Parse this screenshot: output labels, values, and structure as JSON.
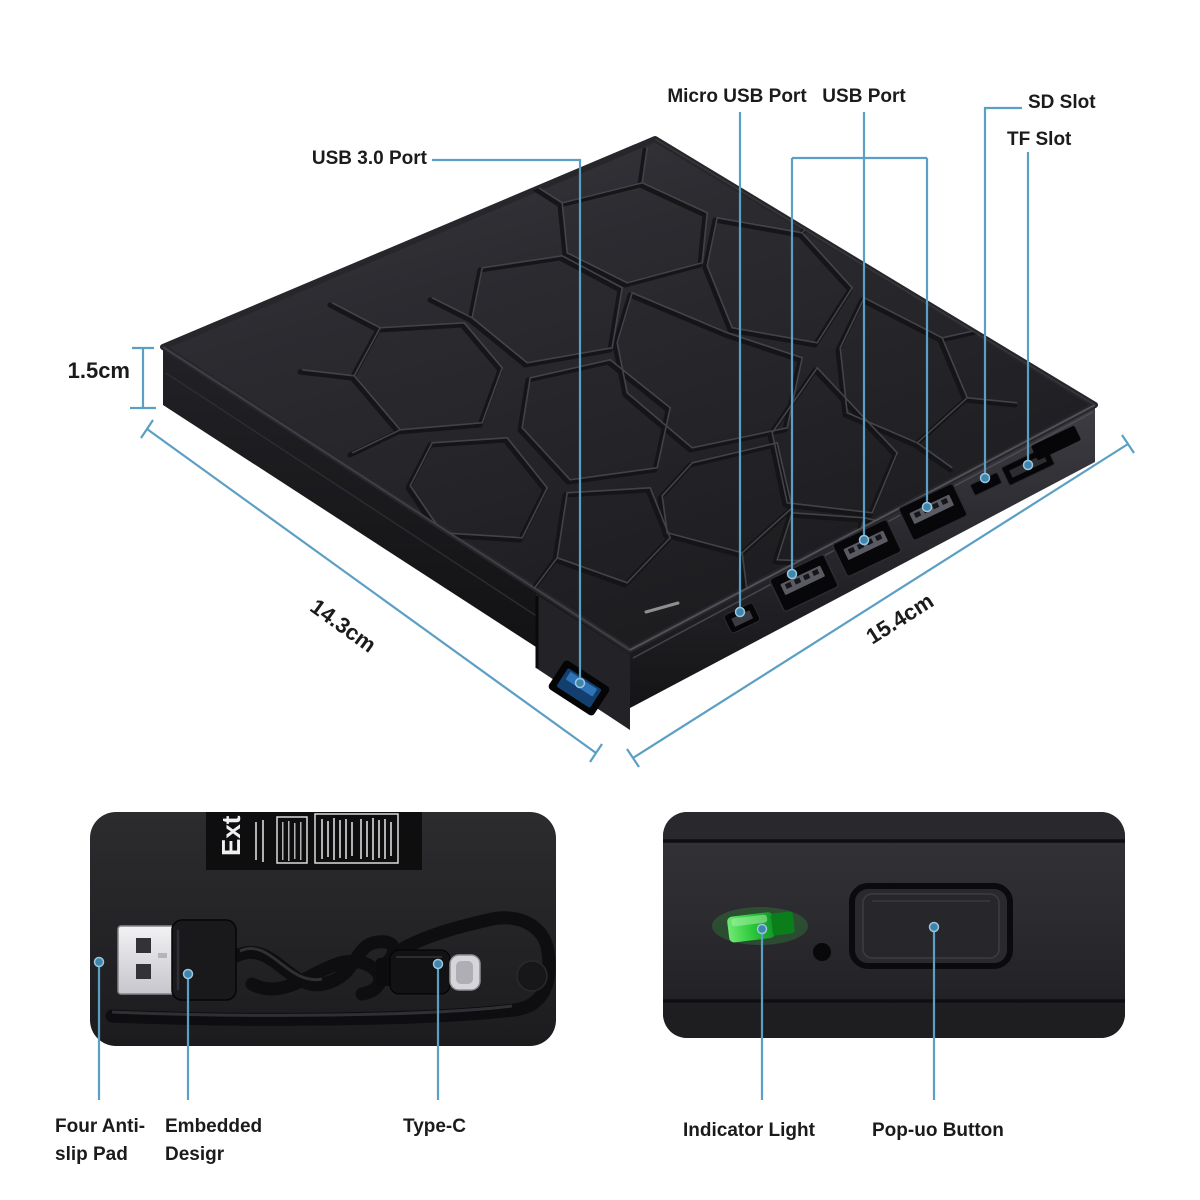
{
  "title": "External slim optical drive annotated product diagram",
  "colors": {
    "background": "#ffffff",
    "leader_line": "#5b9fc4",
    "leader_dot": "#3f85ad",
    "text": "#1b1b1b",
    "device_body": "#27272b",
    "usb3_port_blue": "#2a6db5",
    "indicator_green": "#2fd43c"
  },
  "top_view": {
    "port_labels": {
      "usb3": "USB 3.0 Port",
      "micro_usb": "Micro USB Port",
      "usb": "USB Port",
      "sd": "SD Slot",
      "tf": "TF Slot"
    },
    "dimensions": {
      "thickness": "1.5cm",
      "left_edge": "14.3cm",
      "right_edge": "15.4cm"
    }
  },
  "bottom_left_view": {
    "panel_text": "Ext",
    "labels": {
      "anti_slip_line1": "Four Anti-",
      "anti_slip_line2": "slip Pad",
      "embedded_line1": "Embedded",
      "embedded_line2": "Desigr",
      "type_c": "Type-C"
    }
  },
  "bottom_right_view": {
    "labels": {
      "indicator": "Indicator Light",
      "popup": "Pop-uo Button"
    }
  }
}
